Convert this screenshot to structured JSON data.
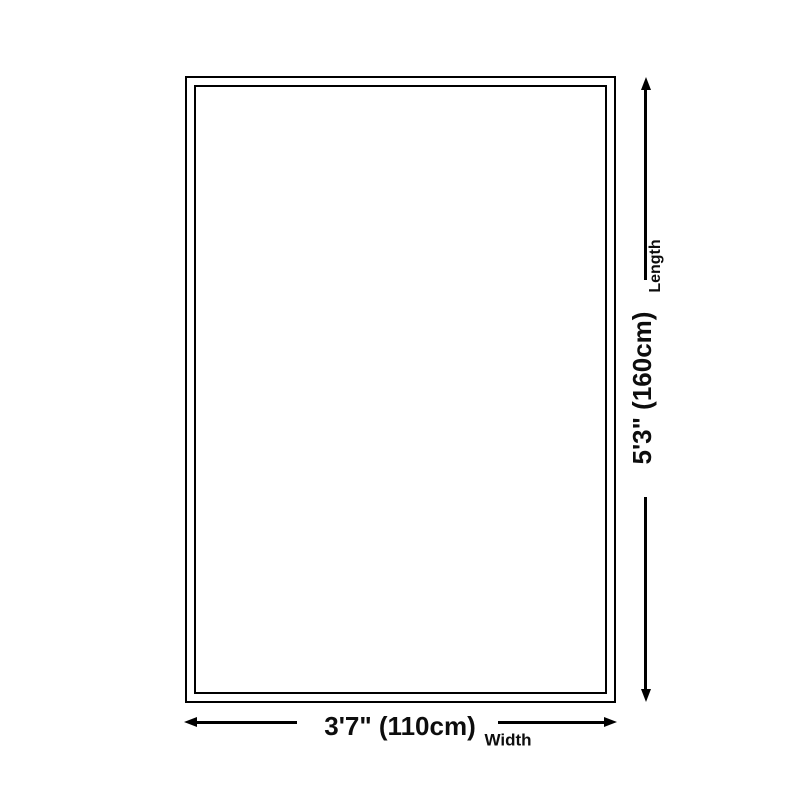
{
  "diagram": {
    "type": "product-dimension-diagram",
    "subject": "rug-outline",
    "dimensions": {
      "length": {
        "label": "Length",
        "value": "5'3\" (160cm)"
      },
      "width": {
        "label": "Width",
        "value": "3'7\" (110cm)"
      }
    },
    "icons": [
      "arrow-up-icon",
      "arrow-down-icon",
      "arrow-left-icon",
      "arrow-right-icon"
    ],
    "colors": {
      "line": "#000000",
      "text": "#0d0d0d",
      "background": "#ffffff"
    }
  }
}
